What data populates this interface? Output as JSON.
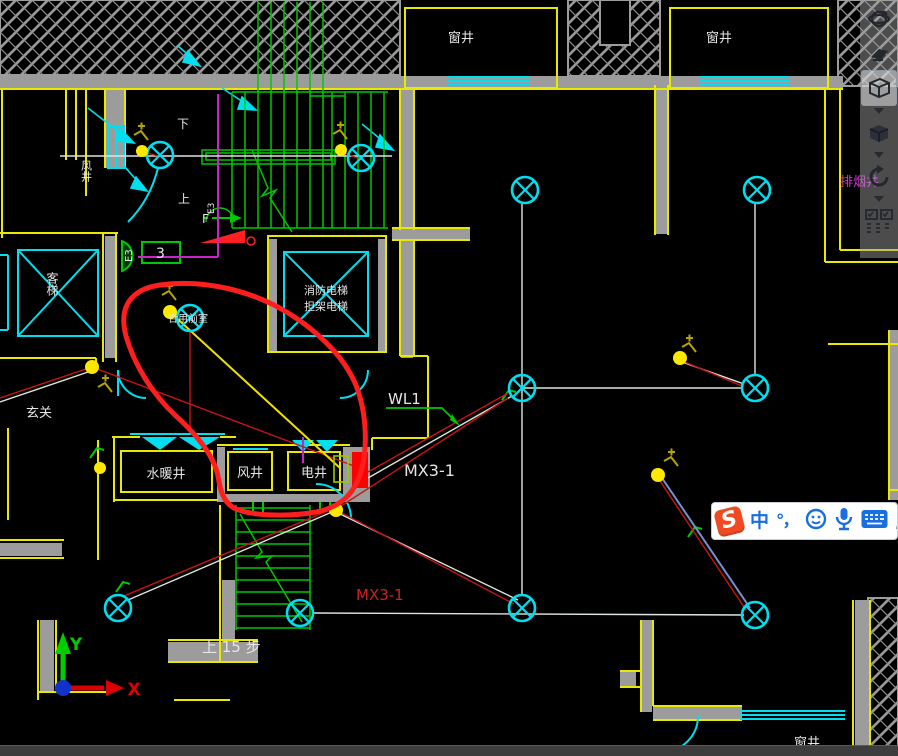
{
  "drawing": {
    "labels": {
      "window_well_top_left": "窗井",
      "window_well_top_right": "窗井",
      "window_well_bottom": "窗井",
      "smoke_exhaust_shaft": "排烟井",
      "air_shaft_left": "风井",
      "passenger_elevator": "客梯",
      "fire_elevator": "消防电梯",
      "stretcher_elevator": "担架电梯",
      "shared_lobby": "合用前室",
      "entrance": "玄关",
      "plumbing_shaft": "水暖井",
      "air_shaft_mid": "风井",
      "electrical_shaft": "电井",
      "circuit_wl1": "WL1",
      "panel_mx31": "MX3-1",
      "panel_mx31_red": "MX3-1",
      "distribution_box_3": "3",
      "door_e3": "E3",
      "stair_up_note": "上 15 步",
      "stair_down": "下",
      "stair_up": "上",
      "evac_f": "F"
    },
    "colors": {
      "background": "#000000",
      "wall_yellow": "#e8e800",
      "wall_gray": "#9c9c9c",
      "line_cyan": "#00dff0",
      "stair_green": "#00c800",
      "wire_white": "#dce6dc",
      "wire_red": "#c81414",
      "wire_blue": "#7b8fd4",
      "cable_magenta": "#cc22cc",
      "lamp_yellow": "#ffe800",
      "annotation_red": "#ff1e1e",
      "text_white": "#e6e6e6",
      "mx31_box_red": "#ff0000"
    }
  },
  "ucs": {
    "x_label": "X",
    "y_label": "Y"
  },
  "ime_bar": {
    "logo": "S",
    "mode": "中",
    "punctuation": "°，",
    "icons": [
      "sogou-logo",
      "chinese-mode",
      "punctuation",
      "emoji",
      "microphone",
      "soft-keyboard",
      "toolbox"
    ]
  },
  "navbar": {
    "icons": [
      "orbit",
      "swivel-view",
      "wireframe-box",
      "solid-box",
      "rotate-view",
      "show-motion"
    ]
  }
}
